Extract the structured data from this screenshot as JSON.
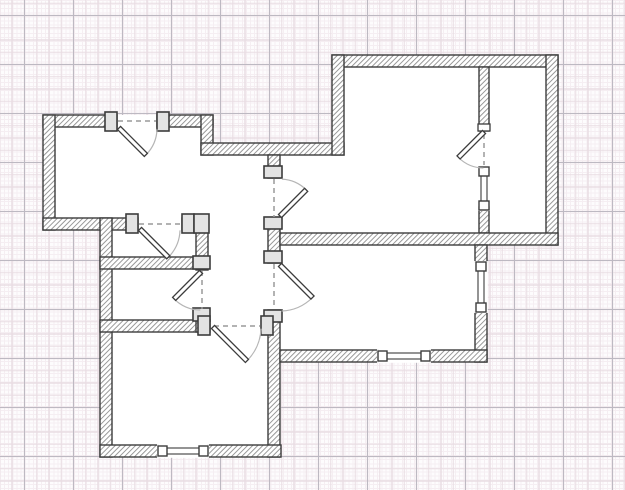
{
  "app": {
    "title": "floor-plan-editor-canvas"
  },
  "canvas": {
    "width": 625,
    "height": 490
  },
  "grid": {
    "paper_color": "#fdfcfd",
    "fine": {
      "spacing": 4.1,
      "color": "#f5eef2"
    },
    "medium": {
      "spacing": 12.25,
      "color": "#e9dde3"
    },
    "major": {
      "spacing": 49,
      "color": "#bdb9c2",
      "offset_x": 24,
      "offset_y": 15
    }
  },
  "style": {
    "wall_stroke": "#3c3c3c",
    "wall_stroke_width": 1.4,
    "hatch_color": "#8e8e8e",
    "hatch_spacing": 3.6,
    "floor_fill": "#ffffff",
    "jamb_fill": "#e3e3e3",
    "cap_fill": "#ffffff",
    "panel_fill": "#ffffff",
    "arc_color": "#b5b5b5",
    "dash_color": "#9a9a9a"
  },
  "floorplan": {
    "floor_areas": [
      [
        43,
        115,
        170,
        115
      ],
      [
        201,
        143,
        143,
        12
      ],
      [
        213,
        155,
        67,
        75
      ],
      [
        268,
        155,
        64,
        90
      ],
      [
        332,
        55,
        226,
        190
      ],
      [
        100,
        218,
        181,
        239
      ],
      [
        268,
        245,
        219,
        117
      ]
    ],
    "walls": [
      [
        43,
        115,
        74,
        12
      ],
      [
        157,
        115,
        56,
        12
      ],
      [
        43,
        115,
        12,
        115
      ],
      [
        43,
        218,
        95,
        12
      ],
      [
        182,
        218,
        26,
        12
      ],
      [
        201,
        115,
        12,
        40
      ],
      [
        201,
        143,
        143,
        12
      ],
      [
        196,
        218,
        12,
        52
      ],
      [
        100,
        218,
        12,
        239
      ],
      [
        100,
        257,
        96,
        12
      ],
      [
        100,
        320,
        110,
        12
      ],
      [
        196,
        310,
        12,
        22
      ],
      [
        268,
        155,
        12,
        23
      ],
      [
        268,
        218,
        12,
        45
      ],
      [
        268,
        310,
        12,
        147
      ],
      [
        332,
        55,
        226,
        12
      ],
      [
        332,
        55,
        12,
        100
      ],
      [
        546,
        55,
        12,
        190
      ],
      [
        479,
        67,
        10,
        64
      ],
      [
        479,
        207,
        10,
        26
      ],
      [
        280,
        233,
        278,
        12
      ],
      [
        475,
        245,
        12,
        17
      ],
      [
        475,
        312,
        12,
        50
      ],
      [
        280,
        350,
        98,
        12
      ],
      [
        430,
        350,
        57,
        12
      ],
      [
        100,
        445,
        58,
        12
      ],
      [
        208,
        445,
        73,
        12
      ]
    ],
    "jambs": [
      [
        105,
        112,
        12,
        19
      ],
      [
        157,
        112,
        12,
        19
      ],
      [
        126,
        214,
        12,
        19
      ],
      [
        182,
        214,
        12,
        19
      ],
      [
        194,
        214,
        15,
        19
      ],
      [
        264,
        166,
        18,
        12
      ],
      [
        264,
        217,
        18,
        12
      ],
      [
        264,
        251,
        18,
        12
      ],
      [
        264,
        310,
        18,
        12
      ],
      [
        193,
        256,
        17,
        13
      ],
      [
        193,
        308,
        17,
        13
      ],
      [
        198,
        316,
        12,
        19
      ],
      [
        261,
        316,
        12,
        19
      ]
    ],
    "caps": [
      [
        478,
        124,
        12,
        7
      ]
    ],
    "windows": [
      {
        "x": 158,
        "y": 445,
        "len": 50,
        "thick": 12,
        "dir": "h"
      },
      {
        "x": 378,
        "y": 350,
        "len": 52,
        "thick": 12,
        "dir": "h"
      },
      {
        "x": 475,
        "y": 262,
        "len": 50,
        "thick": 12,
        "dir": "v"
      },
      {
        "x": 479,
        "y": 167,
        "len": 43,
        "thick": 10,
        "dir": "v"
      }
    ],
    "door_dashes": [
      [
        118,
        121,
        156,
        121
      ],
      [
        139,
        224,
        181,
        224
      ],
      [
        274,
        179,
        274,
        217
      ],
      [
        274,
        264,
        274,
        309
      ],
      [
        484,
        134,
        484,
        165
      ],
      [
        202,
        271,
        202,
        309
      ],
      [
        214,
        326,
        260,
        326
      ]
    ],
    "doors": [
      {
        "hinge": [
          119,
          128
        ],
        "radius": 38,
        "panel_deg": 45,
        "arc_from": 2,
        "arc_to": 45,
        "sweep": 1
      },
      {
        "hinge": [
          140,
          229
        ],
        "radius": 40,
        "panel_deg": 45,
        "arc_from": 2,
        "arc_to": 45,
        "sweep": 1
      },
      {
        "hinge": [
          280,
          216
        ],
        "radius": 37,
        "panel_deg": -45,
        "arc_from": -87,
        "arc_to": -45,
        "sweep": 1
      },
      {
        "hinge": [
          280,
          265
        ],
        "radius": 46,
        "panel_deg": 45,
        "arc_from": 88,
        "arc_to": 45,
        "sweep": 0
      },
      {
        "hinge": [
          484,
          132
        ],
        "radius": 36,
        "panel_deg": 135,
        "arc_from": 91,
        "arc_to": 135,
        "sweep": 1
      },
      {
        "hinge": [
          201,
          272
        ],
        "radius": 38,
        "panel_deg": 135,
        "arc_from": 91,
        "arc_to": 135,
        "sweep": 1
      },
      {
        "hinge": [
          213,
          327
        ],
        "radius": 48,
        "panel_deg": 45,
        "arc_from": 2,
        "arc_to": 45,
        "sweep": 1
      }
    ]
  }
}
